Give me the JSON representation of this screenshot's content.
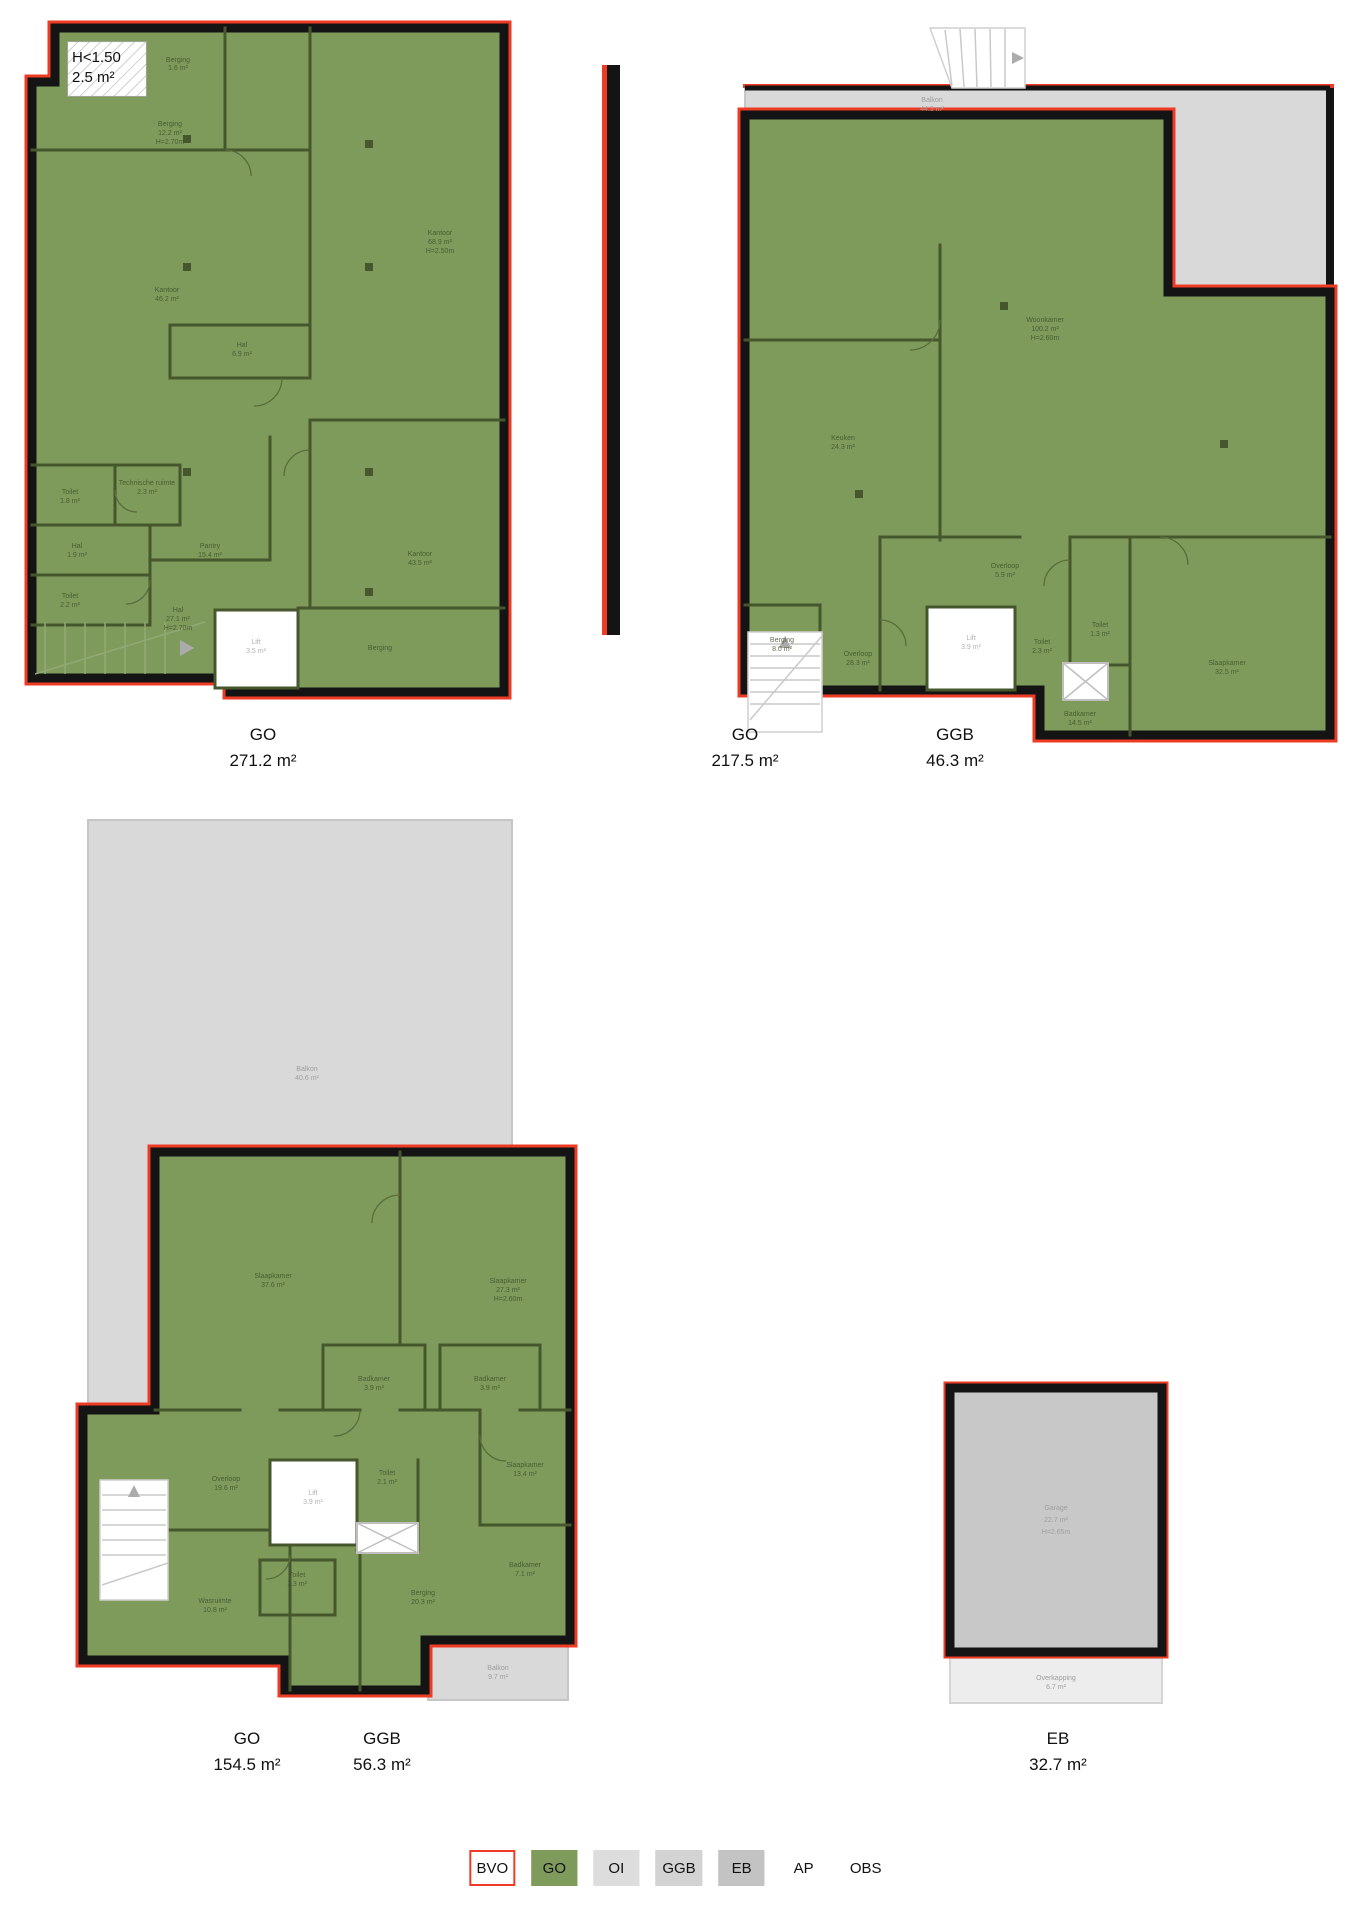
{
  "plans": {
    "plan1": {
      "caption": {
        "code": "GO",
        "area": "271.2 m²"
      },
      "hatch": {
        "line1": "H<1.50",
        "line2": "2.5 m²"
      },
      "rooms": {
        "berging_klein": {
          "name": "Berging",
          "area": "1.6 m²"
        },
        "berging": {
          "name": "Berging",
          "area": "12.2 m²",
          "height": "H=2.70m"
        },
        "kantoor_links": {
          "name": "Kantoor",
          "area": "46.2 m²"
        },
        "kantoor_rechtsboven": {
          "name": "Kantoor",
          "area": "68.9 m²",
          "height": "H=2.50m"
        },
        "hal_midden": {
          "name": "Hal",
          "area": "6.9 m²"
        },
        "technische_ruimte": {
          "name": "Technische ruimte",
          "area": "2.3 m²"
        },
        "toilet_boven": {
          "name": "Toilet",
          "area": "1.8 m²"
        },
        "hal_klein": {
          "name": "Hal",
          "area": "1.9 m²"
        },
        "toilet_onder": {
          "name": "Toilet",
          "area": "2.2 m²"
        },
        "pantry": {
          "name": "Pantry",
          "area": "15.4 m²"
        },
        "kantoor_rechts": {
          "name": "Kantoor",
          "area": "43.5 m²"
        },
        "lift": {
          "name": "Lift",
          "area": "3.5 m²"
        },
        "hal_groot": {
          "name": "Hal",
          "area": "27.1 m²",
          "height": "H=2.70m"
        },
        "berging_groot": {
          "name": "Berging"
        }
      }
    },
    "plan2": {
      "caption_go": {
        "code": "GO",
        "area": "217.5 m²"
      },
      "caption_ggb": {
        "code": "GGB",
        "area": "46.3 m²"
      },
      "rooms": {
        "balkon": {
          "name": "Balkon",
          "area": "44.3 m²"
        },
        "woonkamer": {
          "name": "Woonkamer",
          "area": "100.2 m²",
          "height": "H=2.60m"
        },
        "keuken": {
          "name": "Keuken",
          "area": "24.3 m²"
        },
        "overloop_klein": {
          "name": "Overloop",
          "area": "5.9 m²"
        },
        "overloop_groot": {
          "name": "Overloop",
          "area": "28.3 m²"
        },
        "berging": {
          "name": "Berging",
          "area": "8.0 m²"
        },
        "lift": {
          "name": "Lift",
          "area": "3.9 m²"
        },
        "toilet_groot": {
          "name": "Toilet",
          "area": "2.3 m²"
        },
        "toilet_klein": {
          "name": "Toilet",
          "area": "1.3 m²"
        },
        "slaapkamer": {
          "name": "Slaapkamer",
          "area": "32.5 m²"
        },
        "badkamer": {
          "name": "Badkamer",
          "area": "14.5 m²"
        }
      }
    },
    "plan3": {
      "caption_go": {
        "code": "GO",
        "area": "154.5 m²"
      },
      "caption_ggb": {
        "code": "GGB",
        "area": "56.3 m²"
      },
      "rooms": {
        "balkon": {
          "name": "Balkon",
          "area": "40.6 m²"
        },
        "slaapkamer_links": {
          "name": "Slaapkamer",
          "area": "37.6 m²"
        },
        "slaapkamer_rechts": {
          "name": "Slaapkamer",
          "area": "27.3 m²",
          "height": "H=2.60m"
        },
        "badkamer_links": {
          "name": "Badkamer",
          "area": "3.9 m²"
        },
        "badkamer_rechts": {
          "name": "Badkamer",
          "area": "3.9 m²"
        },
        "overloop": {
          "name": "Overloop",
          "area": "19.6 m²"
        },
        "lift": {
          "name": "Lift",
          "area": "3.9 m²"
        },
        "toilet": {
          "name": "Toilet",
          "area": "2.1 m²"
        },
        "toilet_klein": {
          "name": "Toilet",
          "area": "1.3 m²"
        },
        "wasruimte": {
          "name": "Wasruimte",
          "area": "10.8 m²"
        },
        "berging": {
          "name": "Berging",
          "area": "20.3 m²"
        },
        "slaapkamer_klein": {
          "name": "Slaapkamer",
          "area": "13.4 m²"
        },
        "badkamer": {
          "name": "Badkamer",
          "area": "7.1 m²"
        },
        "balkon_klein": {
          "name": "Balkon",
          "area": "9.7 m²"
        }
      }
    },
    "garage": {
      "caption": {
        "code": "EB",
        "area": "32.7 m²"
      },
      "rooms": {
        "garage": {
          "name": "Garage",
          "area": "22.7 m²",
          "height": "H=2.65m"
        },
        "overkapping": {
          "name": "Overkapping",
          "area": "6.7 m²"
        }
      }
    }
  },
  "legend": {
    "items": [
      {
        "label": "BVO",
        "swatch": "#FFFFFF",
        "border": "#EE3B26"
      },
      {
        "label": "GO",
        "swatch": "#7E9B5B",
        "border": "#7E9B5B"
      },
      {
        "label": "OI",
        "swatch": "#DDDDDD",
        "border": "#DDDDDD"
      },
      {
        "label": "GGB",
        "swatch": "#D3D3D3",
        "border": "#D3D3D3"
      },
      {
        "label": "EB",
        "swatch": "#C3C3C3",
        "border": "#C3C3C3"
      },
      {
        "label": "AP",
        "swatch": "transparent",
        "border": "transparent"
      },
      {
        "label": "OBS",
        "swatch": "transparent",
        "border": "transparent"
      }
    ]
  },
  "colors": {
    "go_fill": "#7E9B5B",
    "inner_wall": "#46572E",
    "outline_red": "#EE3B26",
    "wall_black": "#141414",
    "balcony_gray": "#D9D9D9",
    "garage_gray": "#C8C8C8"
  }
}
